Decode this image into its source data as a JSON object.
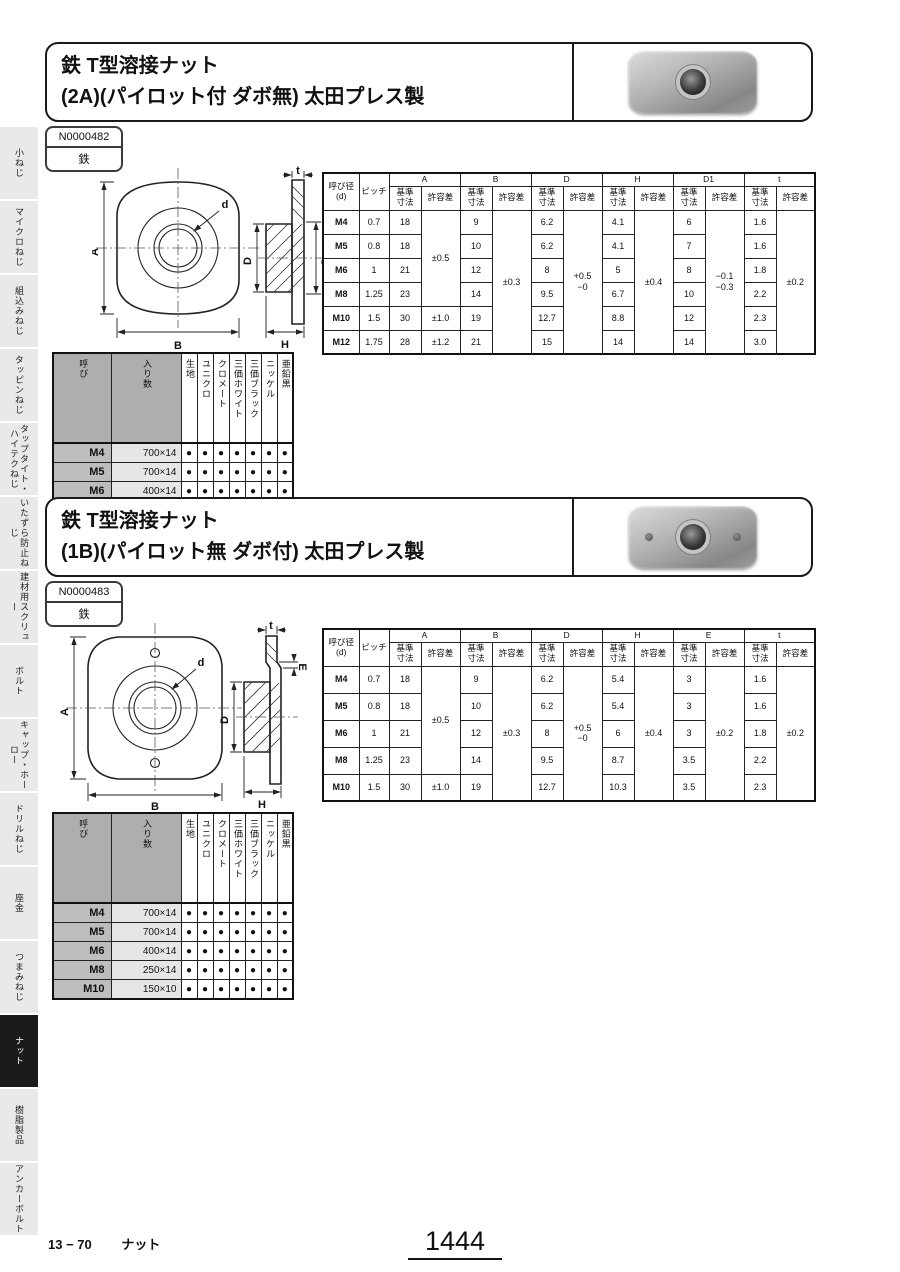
{
  "sidebar": {
    "items": [
      {
        "id": "koneji",
        "label": "小ねじ",
        "active": false
      },
      {
        "id": "micro-neji",
        "label": "マイクロねじ",
        "active": false
      },
      {
        "id": "kumikomi-neji",
        "label": "組込みねじ",
        "active": false
      },
      {
        "id": "tapping-neji",
        "label": "タッピンねじ",
        "active": false
      },
      {
        "id": "taptite-hitech-neji",
        "label": "タップタイト・ハイテクねじ",
        "active": false
      },
      {
        "id": "itazura-boushi-neji",
        "label": "いたずら防止ねじ",
        "active": false
      },
      {
        "id": "kenzai-screw",
        "label": "建材用スクリュー",
        "active": false
      },
      {
        "id": "bolt",
        "label": "ボルト",
        "active": false
      },
      {
        "id": "cap-horo",
        "label": "キャップ・ホーロー",
        "active": false
      },
      {
        "id": "drill-neji",
        "label": "ドリルねじ",
        "active": false
      },
      {
        "id": "zagane",
        "label": "座金",
        "active": false
      },
      {
        "id": "tsumami-neji",
        "label": "つまみねじ",
        "active": false
      },
      {
        "id": "nut",
        "label": "ナット",
        "active": true
      },
      {
        "id": "jushi-seihin",
        "label": "樹脂製品",
        "active": false
      },
      {
        "id": "anchor-bolt",
        "label": "アンカーボルト",
        "active": false
      }
    ]
  },
  "sections": [
    {
      "title_line1": "鉄 T型溶接ナット",
      "title_line2": "(2A)(パイロット付 ダボ無) 太田プレス製",
      "code": "N0000482",
      "material": "鉄",
      "drawing_labels": {
        "a": "A",
        "b": "B",
        "d": "d",
        "t": "t",
        "D": "D",
        "d1": "D₁",
        "h": "H"
      },
      "dim_table": {
        "head_size": "呼び径\n(d)",
        "head_pitch": "ピッチ",
        "sub_basic": "基準\n寸法",
        "sub_tol": "許容差",
        "groups": [
          "A",
          "B",
          "D",
          "H",
          "D1",
          "t"
        ],
        "rows": [
          {
            "size": "M4",
            "pitch": "0.7",
            "basic": [
              "18",
              "9",
              "6.2",
              "4.1",
              "6",
              "1.6"
            ]
          },
          {
            "size": "M5",
            "pitch": "0.8",
            "basic": [
              "18",
              "10",
              "6.2",
              "4.1",
              "7",
              "1.6"
            ]
          },
          {
            "size": "M6",
            "pitch": "1",
            "basic": [
              "21",
              "12",
              "8",
              "5",
              "8",
              "1.8"
            ]
          },
          {
            "size": "M8",
            "pitch": "1.25",
            "basic": [
              "23",
              "14",
              "9.5",
              "6.7",
              "10",
              "2.2"
            ]
          },
          {
            "size": "M10",
            "pitch": "1.5",
            "basic": [
              "30",
              "19",
              "12.7",
              "8.8",
              "12",
              "2.3"
            ]
          },
          {
            "size": "M12",
            "pitch": "1.75",
            "basic": [
              "28",
              "21",
              "15",
              "14",
              "14",
              "3.0"
            ]
          }
        ],
        "tolerances": [
          [
            {
              "text": "±0.5",
              "span": 4
            },
            {
              "text": "±1.0",
              "span": 1
            },
            {
              "text": "±1.2",
              "span": 1
            }
          ],
          [
            {
              "text": "±0.3",
              "span": 6
            }
          ],
          [
            {
              "text": "+0.5\n−0",
              "span": 6
            }
          ],
          [
            {
              "text": "±0.4",
              "span": 6
            }
          ],
          [
            {
              "text": "−0.1\n−0.3",
              "span": 6
            }
          ],
          [
            {
              "text": "±0.2",
              "span": 6
            }
          ]
        ]
      },
      "pack_table": {
        "head_size": "呼び",
        "head_qty": "入り数",
        "finishes": [
          "生地",
          "ユニクロ",
          "クロメート",
          "三価ホワイト",
          "三価ブラック",
          "ニッケル",
          "亜鉛黒"
        ],
        "dot": "●",
        "rows": [
          {
            "size": "M4",
            "qty": "700×14",
            "dots": [
              1,
              1,
              1,
              1,
              1,
              1,
              1
            ]
          },
          {
            "size": "M5",
            "qty": "700×14",
            "dots": [
              1,
              1,
              1,
              1,
              1,
              1,
              1
            ]
          },
          {
            "size": "M6",
            "qty": "400×14",
            "dots": [
              1,
              1,
              1,
              1,
              1,
              1,
              1
            ]
          },
          {
            "size": "M8",
            "qty": "250×14",
            "dots": [
              1,
              1,
              1,
              1,
              1,
              1,
              1
            ]
          },
          {
            "size": "M10",
            "qty": "150×10",
            "dots": [
              1,
              1,
              1,
              1,
              1,
              1,
              1
            ]
          },
          {
            "size": "M12",
            "qty": "150×8",
            "dots": [
              1,
              1,
              1,
              1,
              1,
              1,
              1
            ]
          }
        ]
      }
    },
    {
      "title_line1": "鉄 T型溶接ナット",
      "title_line2": "(1B)(パイロット無 ダボ付) 太田プレス製",
      "code": "N0000483",
      "material": "鉄",
      "drawing_labels": {
        "a": "A",
        "b": "B",
        "d": "d",
        "t": "t",
        "D": "D",
        "e": "E",
        "h": "H"
      },
      "dim_table": {
        "head_size": "呼び径\n(d)",
        "head_pitch": "ピッチ",
        "sub_basic": "基準\n寸法",
        "sub_tol": "許容差",
        "groups": [
          "A",
          "B",
          "D",
          "H",
          "E",
          "t"
        ],
        "rows": [
          {
            "size": "M4",
            "pitch": "0.7",
            "basic": [
              "18",
              "9",
              "6.2",
              "5.4",
              "3",
              "1.6"
            ]
          },
          {
            "size": "M5",
            "pitch": "0.8",
            "basic": [
              "18",
              "10",
              "6.2",
              "5.4",
              "3",
              "1.6"
            ]
          },
          {
            "size": "M6",
            "pitch": "1",
            "basic": [
              "21",
              "12",
              "8",
              "6",
              "3",
              "1.8"
            ]
          },
          {
            "size": "M8",
            "pitch": "1.25",
            "basic": [
              "23",
              "14",
              "9.5",
              "8.7",
              "3.5",
              "2.2"
            ]
          },
          {
            "size": "M10",
            "pitch": "1.5",
            "basic": [
              "30",
              "19",
              "12.7",
              "10.3",
              "3.5",
              "2.3"
            ]
          }
        ],
        "tolerances": [
          [
            {
              "text": "±0.5",
              "span": 4
            },
            {
              "text": "±1.0",
              "span": 1
            }
          ],
          [
            {
              "text": "±0.3",
              "span": 5
            }
          ],
          [
            {
              "text": "+0.5\n−0",
              "span": 5
            }
          ],
          [
            {
              "text": "±0.4",
              "span": 5
            }
          ],
          [
            {
              "text": "±0.2",
              "span": 5
            }
          ],
          [
            {
              "text": "±0.2",
              "span": 5
            }
          ]
        ]
      },
      "pack_table": {
        "head_size": "呼び",
        "head_qty": "入り数",
        "finishes": [
          "生地",
          "ユニクロ",
          "クロメート",
          "三価ホワイト",
          "三価ブラック",
          "ニッケル",
          "亜鉛黒"
        ],
        "dot": "●",
        "rows": [
          {
            "size": "M4",
            "qty": "700×14",
            "dots": [
              1,
              1,
              1,
              1,
              1,
              1,
              1
            ]
          },
          {
            "size": "M5",
            "qty": "700×14",
            "dots": [
              1,
              1,
              1,
              1,
              1,
              1,
              1
            ]
          },
          {
            "size": "M6",
            "qty": "400×14",
            "dots": [
              1,
              1,
              1,
              1,
              1,
              1,
              1
            ]
          },
          {
            "size": "M8",
            "qty": "250×14",
            "dots": [
              1,
              1,
              1,
              1,
              1,
              1,
              1
            ]
          },
          {
            "size": "M10",
            "qty": "150×10",
            "dots": [
              1,
              1,
              1,
              1,
              1,
              1,
              1
            ]
          }
        ]
      }
    }
  ],
  "footer": {
    "code": "13 − 70",
    "label": "ナット",
    "page": "1444"
  }
}
